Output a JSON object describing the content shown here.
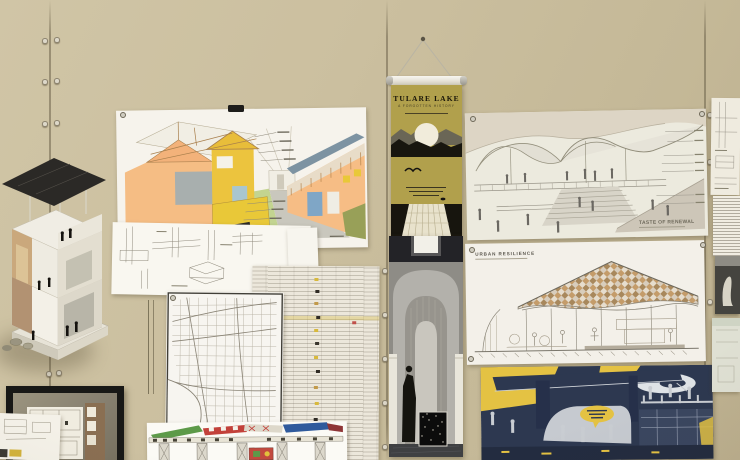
{
  "scene": {
    "wall_color": "#cbbf9f"
  },
  "banner_tulare": {
    "title": "TULARE LAKE",
    "subtitle": "A FORGOTTEN HISTORY",
    "background": "#b1a04c"
  },
  "poster_taste": {
    "title": "TASTE OF RENEWAL"
  },
  "poster_urban": {
    "title": "URBAN RESILIENCE"
  },
  "poster_map": {
    "label": "LOS ANGELES, CA"
  },
  "palette": {
    "navy_poster": "#2d3850",
    "accent_yellow": "#e4c243",
    "model_roof": "#2b2926",
    "drawing_orange": "#f5bd84",
    "drawing_green": "#c3d490"
  }
}
